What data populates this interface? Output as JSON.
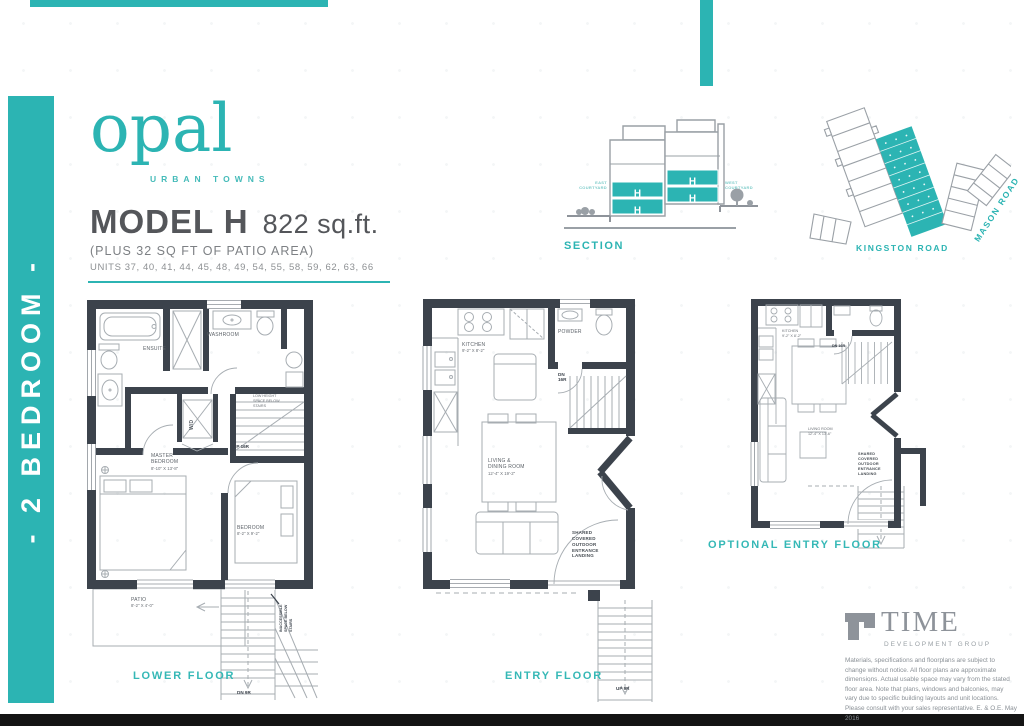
{
  "colors": {
    "teal": "#2CB4B3",
    "wall": "#3C434C",
    "line_gray": "#9AA0A6",
    "text_gray": "#54565A"
  },
  "sidebar": {
    "label": "- 2 BEDROOM -"
  },
  "logo": {
    "name": "opal",
    "tagline": "URBAN TOWNS"
  },
  "header": {
    "model": "MODEL H",
    "area": "822 sq.ft.",
    "patio_note": "(PLUS 32 SQ FT OF PATIO AREA)",
    "units": "UNITS 37, 40, 41, 44, 45, 48, 49, 54, 55, 58, 59, 62, 63, 66"
  },
  "section": {
    "label": "SECTION",
    "unit": "H",
    "east": "EAST COURTYARD",
    "west": "WEST COURTYARD"
  },
  "site": {
    "kingston": "KINGSTON ROAD",
    "mason": "MASON ROAD"
  },
  "lower": {
    "label": "LOWER FLOOR",
    "ensuite": "ENSUITE",
    "washroom": "WASHROOM",
    "wd": "W/D",
    "low_height": "LOW HEIGHT SPACE BELOW STAIRS",
    "up": "UP 16R",
    "dn": "DN 9R",
    "master": "MASTER BEDROOM",
    "master_dim": "8'-10\" X 13'-8\"",
    "bedroom": "BEDROOM",
    "bedroom_dim": "8'-2\" X 9'-2\"",
    "patio": "PATIO",
    "patio_dim": "8'-2\" X 4'-0\"",
    "inaccessible": "INACCESSIBLE SPACE BELOW STAIRS"
  },
  "entry": {
    "label": "ENTRY FLOOR",
    "kitchen": "KITCHEN",
    "kitchen_dim": "9'-2\" X 8'-2\"",
    "powder": "POWDER",
    "dn": "DN 16R",
    "up": "UP 9R",
    "living": "LIVING & DINING ROOM",
    "living_dim": "12'-4\" X 19'-2\"",
    "shared": "SHARED COVERED OUTDOOR ENTRANCE LANDING"
  },
  "optional": {
    "label": "OPTIONAL ENTRY FLOOR",
    "kitchen": "KITCHEN",
    "kitchen_dim": "9'-2\" X 8'-2\"",
    "dn": "DN 16R",
    "living": "LIVING ROOM",
    "living_dim": "12'-4\" X 13'-6\"",
    "shared": "SHARED COVERED OUTDOOR ENTRANCE LANDING"
  },
  "footer": {
    "brand": "TIME",
    "brand_sub": "DEVELOPMENT GROUP",
    "disclaimer": "Materials, specifications and floorplans are subject to change without notice. All floor plans are approximate dimensions. Actual usable space may vary from the stated floor area. Note that plans, windows and balconies, may vary due to specific building layouts and unit locations. Please consult with your sales representative. E. & O.E. May 2016"
  }
}
